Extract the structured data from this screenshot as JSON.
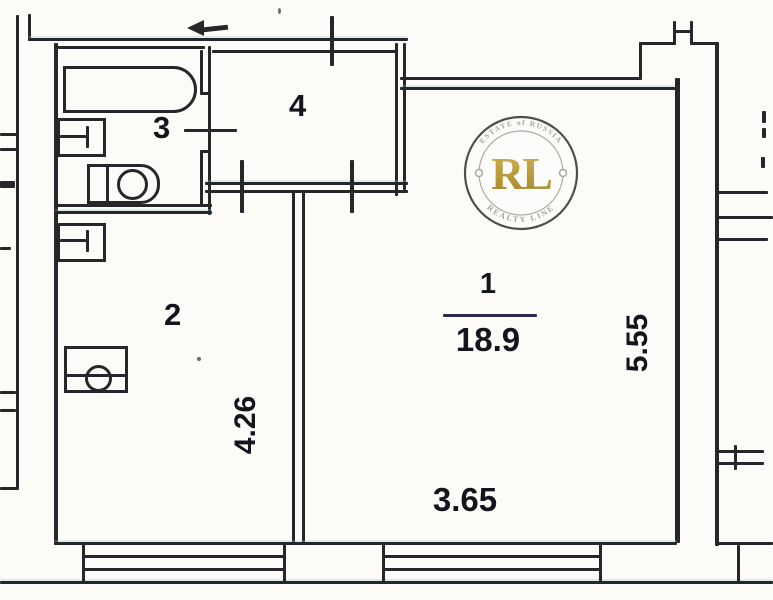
{
  "plan": {
    "rooms": {
      "r1": {
        "number": "1",
        "area": "18.9"
      },
      "r2": {
        "number": "2"
      },
      "r3": {
        "number": "3"
      },
      "r4": {
        "number": "4"
      }
    },
    "dimensions": {
      "room1_width": "3.65",
      "room1_depth": "5.55",
      "room2_depth": "4.26"
    }
  },
  "watermark": {
    "initials": "RL",
    "arc_top": "ESTATE of RUSSIA",
    "arc_bottom": "REALTY LINE",
    "gold_color": "#b5942c",
    "ring_color": "#45403a",
    "arc_text_color": "#a39d92"
  },
  "icons": {
    "entrance_arrow": "left-arrow"
  },
  "colors": {
    "wall": "#26262b",
    "text": "#14141c",
    "fraction_line": "#2b2b52",
    "background": "#fcfbf7"
  }
}
